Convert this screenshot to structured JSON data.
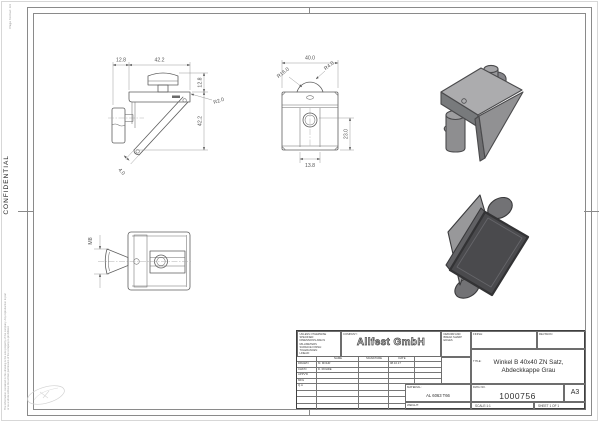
{
  "sheet": {
    "confidential": "CONFIDENTIAL",
    "format_note": "Page format: A3",
    "property_note": "The information contained in this drawing is the sole property of the company. Any reproduction in part or as a whole without the written permission of the company is prohibited."
  },
  "views": {
    "side": {
      "dim_top_left": "12.8",
      "dim_top": "42.2",
      "dim_right_top": "12.8",
      "dim_right": "42.2",
      "radius": "R2.0",
      "thickness": "4.0"
    },
    "front": {
      "dim_width": "40.0",
      "radius_large": "R16.0",
      "radius_small": "R4.0",
      "dim_height": "23.0",
      "dim_bottom": "13.8"
    },
    "top": {
      "thread": "M8"
    }
  },
  "title_block": {
    "notes_line1": "UNLESS OTHERWISE SPECIFIED:",
    "notes_line2": "DIMENSIONS ARE IN MILLIMETERS",
    "notes_line3": "SURFACE FINISH:",
    "notes_line4": "TOLERANCES:",
    "notes_line5": "   LINEAR:",
    "notes_line6": "   ANGULAR:",
    "company_label": "COMPANY:",
    "company_name": "Allfest GmbH",
    "deburr_note": "DEBURR AND BREAK SHARP EDGES",
    "finish_label": "FINISH:",
    "revision_label": "REVISION",
    "approval": {
      "headers": {
        "name": "NAME",
        "signature": "SIGNATURE",
        "date": "DATE"
      },
      "rows": [
        {
          "label": "DRAWN",
          "name": "M. MOHR",
          "date": "08.10.17"
        },
        {
          "label": "CHK'D",
          "name": "D. ROHDE",
          "date": ""
        },
        {
          "label": "APPV'D",
          "name": "",
          "date": ""
        },
        {
          "label": "MFG",
          "name": "",
          "date": ""
        },
        {
          "label": "Q.A",
          "name": "",
          "date": ""
        }
      ]
    },
    "material_label": "MATERIAL:",
    "material": "AL 6063 T66",
    "weight_label": "WEIGHT:",
    "title_label": "TITLE:",
    "title_line1": "Winkel B 40x40 ZN Satz,",
    "title_line2": "Abdeckkappe Grau",
    "dwg_label": "DWG NO.",
    "dwg_no": "1000756",
    "paper_size": "A3",
    "scale": "SCALE:1:1",
    "sheet": "SHEET 1 OF 1"
  }
}
